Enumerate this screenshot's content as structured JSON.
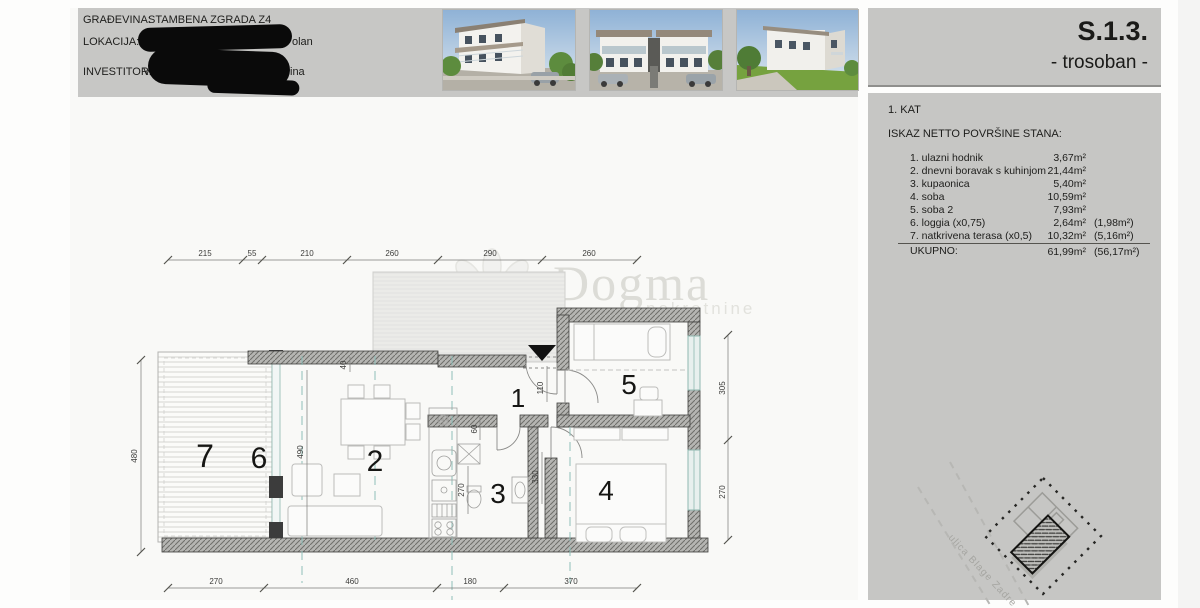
{
  "header": {
    "rows": [
      {
        "label": "GRAĐEVINA:",
        "value": "STAMBENA ZGRADA Z4"
      },
      {
        "label": "LOKACIJA:",
        "visible_fragment": "olan"
      },
      {
        "label": "INVESTITOR:",
        "visible_prefix": "V",
        "visible_fragment": "ina"
      }
    ],
    "photos": [
      "building-render-corner-view",
      "building-render-front-view",
      "building-render-rear-view"
    ]
  },
  "title_panel": {
    "code": "S.1.3.",
    "type": "- trosoban -"
  },
  "area_panel": {
    "floor": "1. KAT",
    "heading": "ISKAZ NETTO POVRŠINE STANA:",
    "rows": [
      {
        "label": "1. ulazni hodnik",
        "area": "3,67m²",
        "reduced": ""
      },
      {
        "label": "2. dnevni boravak s kuhinjom",
        "area": "21,44m²",
        "reduced": ""
      },
      {
        "label": "3. kupaonica",
        "area": "5,40m²",
        "reduced": ""
      },
      {
        "label": "4. soba",
        "area": "10,59m²",
        "reduced": ""
      },
      {
        "label": "5. soba 2",
        "area": "7,93m²",
        "reduced": ""
      },
      {
        "label": "6. loggia (x0,75)",
        "area": "2,64m²",
        "reduced": "(1,98m²)"
      },
      {
        "label": "7. natkrivena terasa (x0,5)",
        "area": "10,32m²",
        "reduced": "(5,16m²)"
      }
    ],
    "total": {
      "label": "UKUPNO:",
      "area": "61,99m²",
      "reduced": "(56,17m²)"
    }
  },
  "plan": {
    "rooms": [
      "1",
      "2",
      "3",
      "4",
      "5",
      "6",
      "7"
    ],
    "dims_top": [
      "215",
      "55",
      "210",
      "260",
      "290",
      "260"
    ],
    "dims_bottom": [
      "270",
      "460",
      "180",
      "370"
    ],
    "dims_left": [
      "480"
    ],
    "dims_right": [
      "305",
      "270"
    ],
    "dims_inner": [
      "490",
      "40",
      "110",
      "60",
      "270",
      "330"
    ]
  },
  "watermark": {
    "name": "Dogma",
    "sub": "nekretnine"
  },
  "site_plan": {
    "street": "ulica Blage Zadre"
  }
}
